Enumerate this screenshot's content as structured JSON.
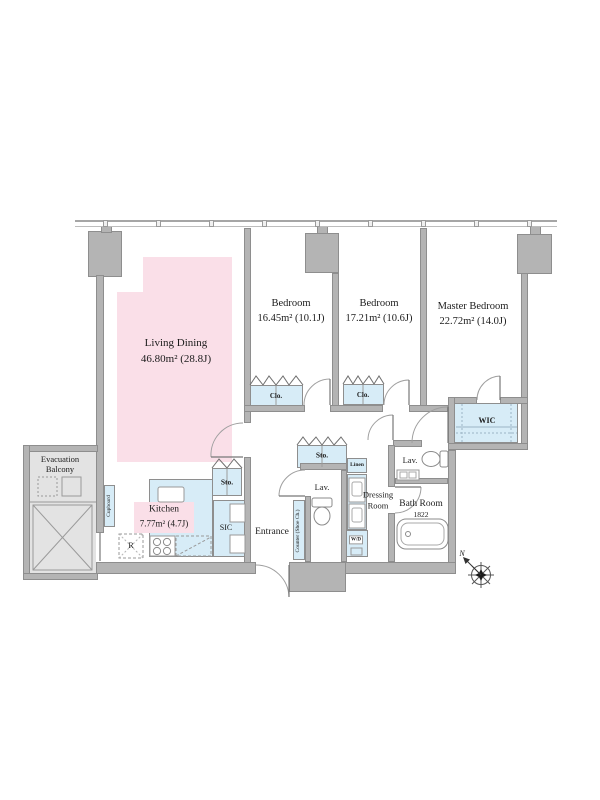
{
  "colors": {
    "wall": "#b4b4b4",
    "wall_border": "#8e8e8e",
    "room_pink": "#fadfe8",
    "fixture_blue": "#d7ecf7",
    "balcony_gray": "#e3e3e3"
  },
  "rooms": {
    "living_dining": {
      "name": "Living Dining",
      "area": "46.80m² (28.8J)"
    },
    "kitchen": {
      "name": "Kitchen",
      "area": "7.77m² (4.7J)"
    },
    "bedroom_1": {
      "name": "Bedroom",
      "area": "16.45m² (10.1J)"
    },
    "bedroom_2": {
      "name": "Bedroom",
      "area": "17.21m² (10.6J)"
    },
    "master_bedroom": {
      "name": "Master Bedroom",
      "area": "22.72m² (14.0J)"
    },
    "bath": {
      "name": "Bath Room",
      "size": "1822"
    },
    "dressing": {
      "line1": "Dressing",
      "line2": "Room"
    },
    "entrance": {
      "name": "Entrance"
    },
    "evacuation_balcony": {
      "line1": "Evacuation",
      "line2": "Balcony"
    }
  },
  "labels": {
    "wic": "WIC",
    "sic": "SIC",
    "sto_kitchen": "Sto.",
    "sto_hall": "Sto.",
    "clo_1": "Clo.",
    "clo_2": "Clo.",
    "linen": "Linen",
    "lav_wc": "Lav.",
    "lav_powder": "Lav.",
    "cupboard": "Cupboard",
    "shoe_counter": "Counter (Shoe Ch.)",
    "refrigerator": "R",
    "washer_dryer": "W/D",
    "compass_north": "N"
  }
}
